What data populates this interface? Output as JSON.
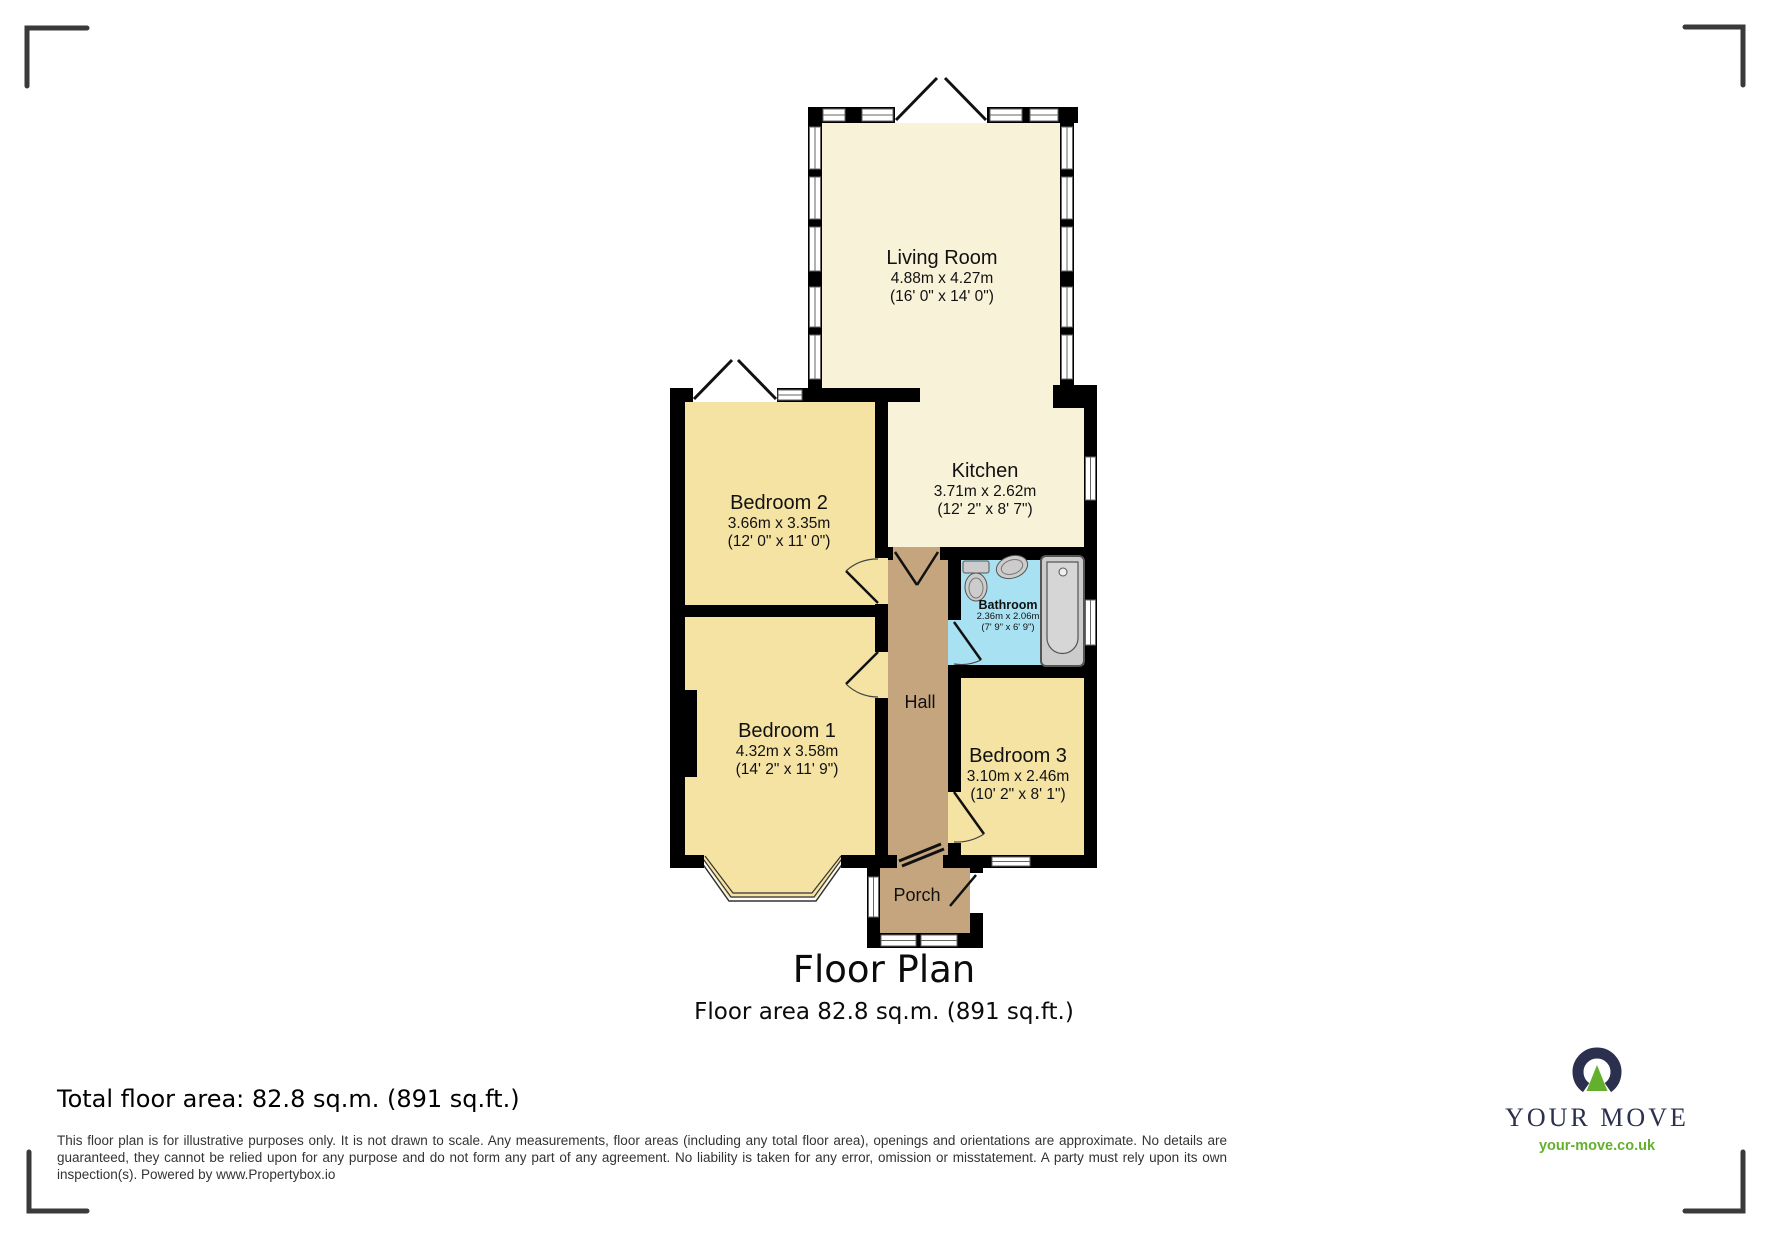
{
  "plan": {
    "title": "Floor Plan",
    "subtitle": "Floor area 82.8 sq.m. (891 sq.ft.)",
    "rooms": [
      {
        "id": "living-room",
        "name": "Living Room",
        "metric": "4.88m x 4.27m",
        "imperial": "(16' 0\" x 14' 0\")"
      },
      {
        "id": "kitchen",
        "name": "Kitchen",
        "metric": "3.71m x 2.62m",
        "imperial": "(12' 2\" x 8' 7\")"
      },
      {
        "id": "bedroom-2",
        "name": "Bedroom 2",
        "metric": "3.66m x 3.35m",
        "imperial": "(12' 0\" x 11' 0\")"
      },
      {
        "id": "bathroom",
        "name": "Bathroom",
        "metric": "2.36m x 2.06m",
        "imperial": "(7' 9\" x 6' 9\")"
      },
      {
        "id": "bedroom-1",
        "name": "Bedroom 1",
        "metric": "4.32m x 3.58m",
        "imperial": "(14' 2\" x 11' 9\")"
      },
      {
        "id": "bedroom-3",
        "name": "Bedroom 3",
        "metric": "3.10m x 2.46m",
        "imperial": "(10' 2\" x 8' 1\")"
      },
      {
        "id": "hall",
        "name": "Hall"
      },
      {
        "id": "porch",
        "name": "Porch"
      }
    ]
  },
  "footer": {
    "total_area": "Total floor area: 82.8 sq.m. (891 sq.ft.)",
    "disclaimer": "This floor plan is for illustrative purposes only. It is not drawn to scale. Any measurements, floor areas (including any total floor area), openings and orientations are approximate. No details are guaranteed, they cannot be relied upon for any purpose and do not form any part of any agreement. No liability is taken for any error, omission or misstatement. A party must rely upon its own inspection(s). Powered by www.Propertybox.io"
  },
  "logo": {
    "brand": "YOUR MOVE",
    "website": "your-move.co.uk"
  },
  "colors": {
    "wall": "#000000",
    "bedroom_fill": "#f5e3a3",
    "living_kitchen_fill": "#f8f2d9",
    "hall_porch_fill": "#c5a57d",
    "bathroom_fill": "#a8e1f2",
    "logo_navy": "#2a304e",
    "logo_green": "#63b02c",
    "crop_mark": "#3a3a3a"
  }
}
